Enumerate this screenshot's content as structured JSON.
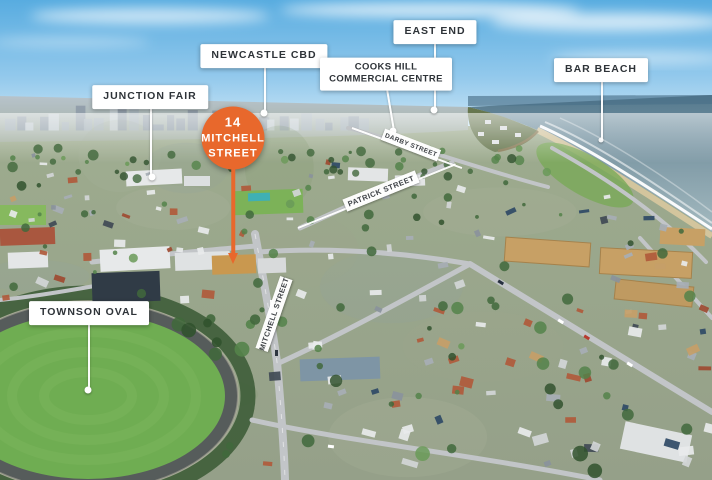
{
  "image_type": "aerial-location-map",
  "annotations": {
    "marker": {
      "line1": "14",
      "line2": "MITCHELL",
      "line3": "STREET",
      "color": "#E8682C",
      "text_color": "#FFFFFF"
    },
    "labels": {
      "junction_fair": {
        "text": "JUNCTION FAIR"
      },
      "newcastle_cbd": {
        "text": "NEWCASTLE CBD"
      },
      "east_end": {
        "text": "EAST END"
      },
      "cooks_hill": {
        "text": "COOKS HILL COMMERCIAL CENTRE"
      },
      "bar_beach": {
        "text": "BAR BEACH"
      },
      "townson_oval": {
        "text": "TOWNSON OVAL"
      }
    },
    "street_ribbons": {
      "darby": {
        "text": "DARBY STREET"
      },
      "patrick": {
        "text": "PATRICK STREET"
      },
      "mitchell": {
        "text": "MITCHELL STREET"
      }
    },
    "label_style": {
      "background": "#FFFFFF",
      "text_color": "#2E3338"
    }
  }
}
